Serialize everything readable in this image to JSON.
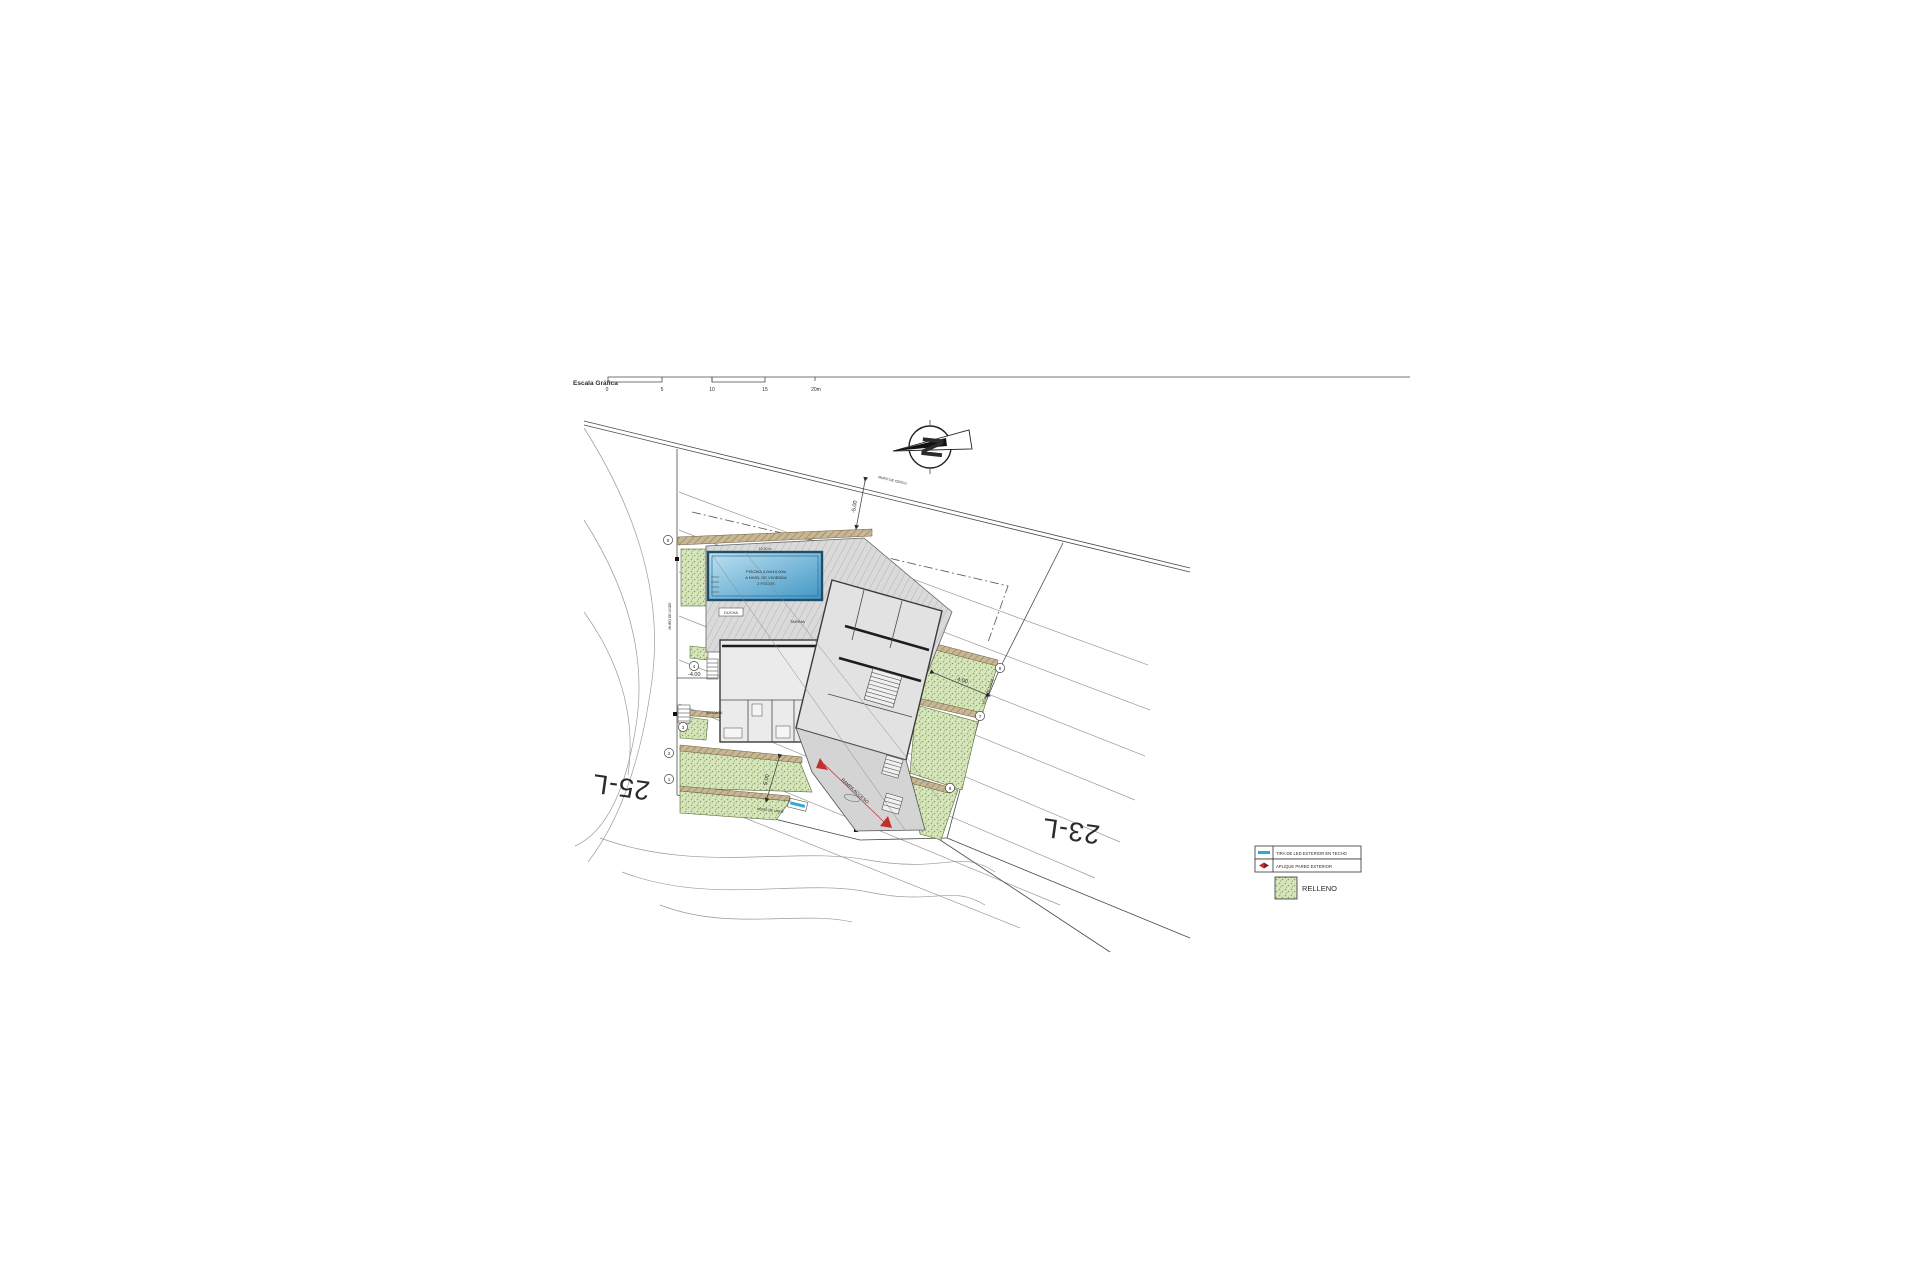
{
  "scale_bar": {
    "label": "Escala Gráfica",
    "ticks": [
      "0",
      "5",
      "10",
      "15",
      "20m"
    ]
  },
  "north_arrow": {
    "letter": "N"
  },
  "plots": {
    "left": "25-L",
    "right": "23-L"
  },
  "pool": {
    "line1": "PISCINA 4,00x10,00m",
    "line2": "A NIVEL DE VIVIENDA",
    "line3": "2 FOCOS",
    "edge_label": "10,30 m"
  },
  "labels": {
    "ducha": "DUCHA",
    "tarima": "TARIMA",
    "bancada": "BANCADA",
    "muro_cerco": "MURO DE CERCO",
    "muro_linde_left": "MURO DE LINDE",
    "muro_linde_right": "MURO DE LINDE",
    "muro_linde_bottom": "MURO DE LINDE",
    "rampa": "RAMPA ACCESO"
  },
  "dimensions": {
    "top": "-5.00",
    "left": "-4.00",
    "right": "4.00",
    "bottom": "5.00"
  },
  "markers": [
    "1",
    "2",
    "3",
    "4",
    "5",
    "6",
    "7",
    "8"
  ],
  "legend": {
    "items": [
      {
        "symbol": "led-strip",
        "label": "TIRA DE LED EXTERIOR EN TECHO",
        "color": "#2fa8d5"
      },
      {
        "symbol": "wall-sconce",
        "label": "APLIQUE PARED EXTERIOR",
        "color": "#c03030"
      }
    ],
    "relleno_label": "RELLENO"
  },
  "colors": {
    "green_fill": "#d7e6bc",
    "tan_wall": "#c7b795",
    "pool_blue": "#4d9dc9",
    "led_blue": "#2fa8d5",
    "red_accent": "#c03030"
  }
}
